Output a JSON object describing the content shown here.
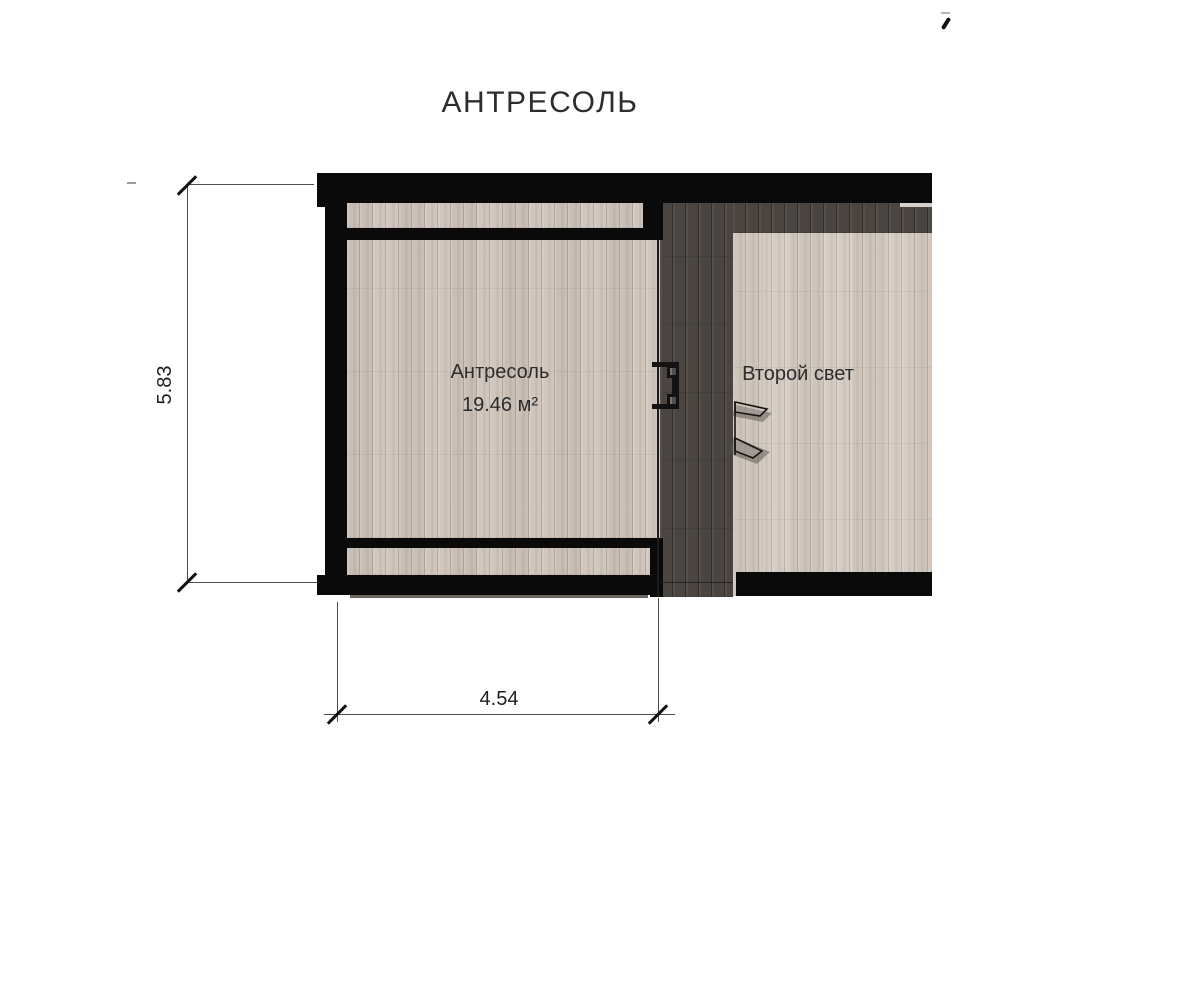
{
  "title": "АНТРЕСОЛЬ",
  "plan": {
    "rooms": [
      {
        "id": "mezzanine",
        "label": "Антресоль",
        "area_label": "19.46 м²"
      },
      {
        "id": "second-light",
        "label": "Второй свет"
      }
    ],
    "dimensions": [
      {
        "id": "height",
        "value": "5.83",
        "orientation": "vertical"
      },
      {
        "id": "width",
        "value": "4.54",
        "orientation": "horizontal"
      }
    ]
  },
  "colors": {
    "bg": "#ffffff",
    "wall": "#0a0a0a",
    "floor_light": "#cdc3ba",
    "floor_light2": "#d2c9c0",
    "floor_dark": "#4a4540",
    "dim_line": "#4d4d4d",
    "dim_text": "#1f1f23",
    "text": "#2d2d2d"
  }
}
